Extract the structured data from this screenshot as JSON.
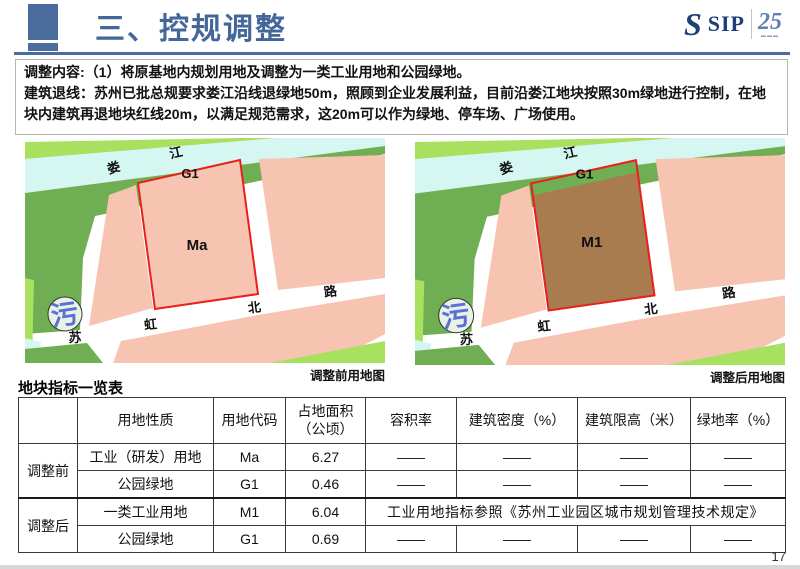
{
  "header": {
    "title": "三、控规调整",
    "logo": {
      "s_glyph": "S",
      "text": "SIP",
      "anniversary": "25"
    },
    "accent_color": "#4a6d9e"
  },
  "intro": {
    "line1": "调整内容:（1）将原基地内规划用地及调整为一类工业用地和公园绿地。",
    "line2": "建筑退线：苏州已批总规要求娄江沿线退绿地50m，照顾到企业发展利益，目前沿娄江地块按照30m绿地进行控制，在地块内建筑再退地块红线20m，以满足规范需求，这20m可以作为绿地、停车场、广场使用。"
  },
  "maps": {
    "colors": {
      "river": "#d5f6f1",
      "light_green": "#a8e060",
      "dark_green": "#6fae52",
      "parcel_pink": "#f6c4b1",
      "parcel_brown": "#a97c4f",
      "red_line": "#e8211d",
      "plant_blue": "#5b6fd6"
    },
    "before": {
      "caption": "调整前用地图",
      "parcel_code": "Ma",
      "green_code": "G1",
      "river_char1": "娄",
      "river_char2": "江",
      "road_char1": "苏",
      "road_char2": "虹",
      "road_char3": "北",
      "road_char4": "路",
      "plant_char": "污"
    },
    "after": {
      "caption": "调整后用地图",
      "parcel_code": "M1",
      "green_code": "G1",
      "river_char1": "娄",
      "river_char2": "江",
      "road_char1": "苏",
      "road_char2": "虹",
      "road_char3": "北",
      "road_char4": "路",
      "plant_char": "污"
    }
  },
  "table": {
    "title": "地块指标一览表",
    "headers": {
      "h1": "用地性质",
      "h2": "用地代码",
      "h3a": "占地面积",
      "h3b": "（公顷）",
      "h4": "容积率",
      "h5": "建筑密度（%）",
      "h6": "建筑限高（米）",
      "h7": "绿地率（%）"
    },
    "group_before": "调整前",
    "group_after": "调整后",
    "rows": {
      "before1": {
        "nature": "工业（研发）用地",
        "code": "Ma",
        "area": "6.27",
        "far": "——",
        "density": "——",
        "height": "——",
        "green": "——"
      },
      "before2": {
        "nature": "公园绿地",
        "code": "G1",
        "area": "0.46",
        "far": "——",
        "density": "——",
        "height": "——",
        "green": "——"
      },
      "after1": {
        "nature": "一类工业用地",
        "code": "M1",
        "area": "6.04",
        "note": "工业用地指标参照《苏州工业园区城市规划管理技术规定》"
      },
      "after2": {
        "nature": "公园绿地",
        "code": "G1",
        "area": "0.69",
        "far": "——",
        "density": "——",
        "height": "——",
        "green": "——"
      }
    }
  },
  "page_number": "17"
}
